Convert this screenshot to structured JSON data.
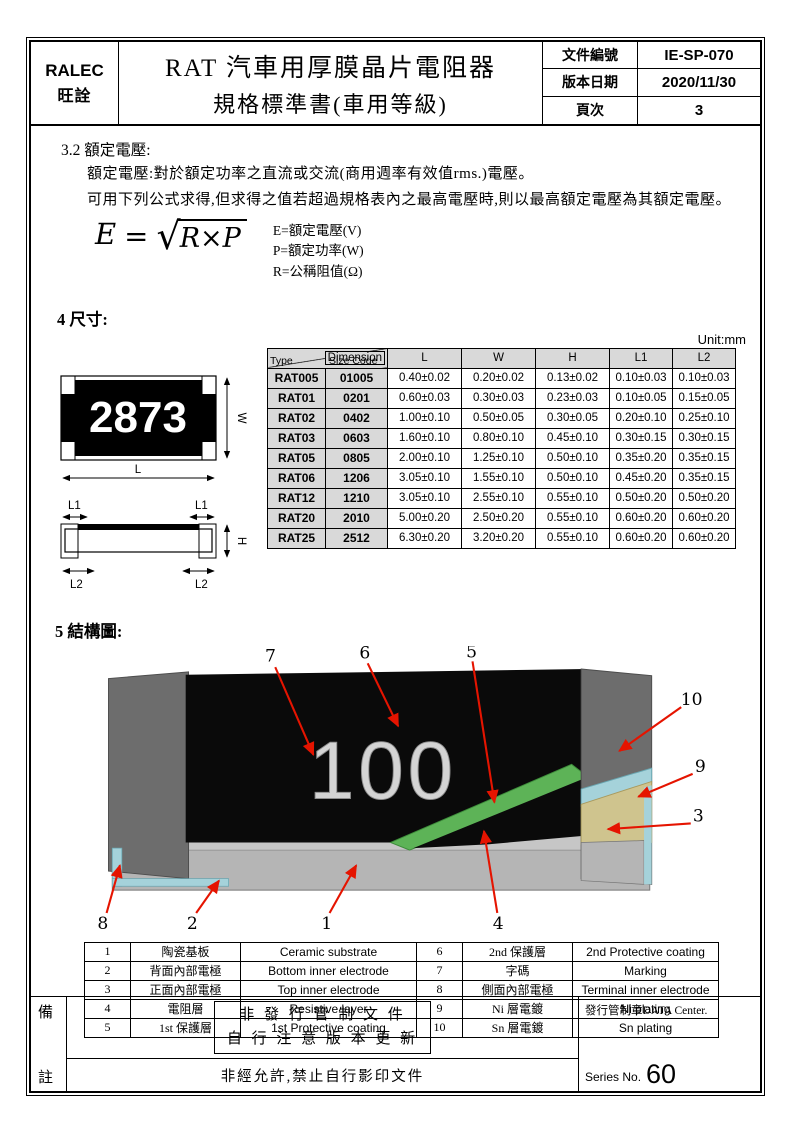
{
  "header": {
    "company_en": "RALEC",
    "company_cn": "旺詮",
    "title_line1": "RAT 汽車用厚膜晶片電阻器",
    "title_line2": "規格標準書(車用等級)",
    "doc_no_label": "文件編號",
    "doc_no": "IE-SP-070",
    "version_date_label": "版本日期",
    "version_date": "2020/11/30",
    "page_label": "頁次",
    "page_no": "3"
  },
  "section_rated_voltage": {
    "number": "3.2",
    "title": "額定電壓:",
    "line1": "額定電壓:對於額定功率之直流或交流(商用週率有效值rms.)電壓。",
    "line2": "可用下列公式求得,但求得之值若超過規格表內之最高電壓時,則以最高額定電壓為其額定電壓。",
    "formula": {
      "lhs": "E",
      "eq": "=",
      "radical": "√",
      "radicand": "R×P"
    },
    "legend": [
      "E=額定電壓(V)",
      "P=額定功率(W)",
      "R=公稱阻值(Ω)"
    ]
  },
  "section_dimensions": {
    "number": "4",
    "title": "尺寸:",
    "unit": "Unit:mm",
    "marking_example": "2873",
    "dim_labels": {
      "L": "L",
      "W": "W",
      "H": "H",
      "L1": "L1",
      "L2": "L2"
    },
    "table": {
      "corner_top": "Dimension",
      "corner_left": "Type",
      "corner_mid": "Size Code",
      "columns": [
        "L",
        "W",
        "H",
        "L1",
        "L2"
      ],
      "rows": [
        {
          "type": "RAT005",
          "size_code": "01005",
          "values": [
            "0.40±0.02",
            "0.20±0.02",
            "0.13±0.02",
            "0.10±0.03",
            "0.10±0.03"
          ]
        },
        {
          "type": "RAT01",
          "size_code": "0201",
          "values": [
            "0.60±0.03",
            "0.30±0.03",
            "0.23±0.03",
            "0.10±0.05",
            "0.15±0.05"
          ]
        },
        {
          "type": "RAT02",
          "size_code": "0402",
          "values": [
            "1.00±0.10",
            "0.50±0.05",
            "0.30±0.05",
            "0.20±0.10",
            "0.25±0.10"
          ]
        },
        {
          "type": "RAT03",
          "size_code": "0603",
          "values": [
            "1.60±0.10",
            "0.80±0.10",
            "0.45±0.10",
            "0.30±0.15",
            "0.30±0.15"
          ]
        },
        {
          "type": "RAT05",
          "size_code": "0805",
          "values": [
            "2.00±0.10",
            "1.25±0.10",
            "0.50±0.10",
            "0.35±0.20",
            "0.35±0.15"
          ]
        },
        {
          "type": "RAT06",
          "size_code": "1206",
          "values": [
            "3.05±0.10",
            "1.55±0.10",
            "0.50±0.10",
            "0.45±0.20",
            "0.35±0.15"
          ]
        },
        {
          "type": "RAT12",
          "size_code": "1210",
          "values": [
            "3.05±0.10",
            "2.55±0.10",
            "0.55±0.10",
            "0.50±0.20",
            "0.50±0.20"
          ]
        },
        {
          "type": "RAT20",
          "size_code": "2010",
          "values": [
            "5.00±0.20",
            "2.50±0.20",
            "0.55±0.10",
            "0.60±0.20",
            "0.60±0.20"
          ]
        },
        {
          "type": "RAT25",
          "size_code": "2512",
          "values": [
            "6.30±0.20",
            "3.20±0.20",
            "0.55±0.10",
            "0.60±0.20",
            "0.60±0.20"
          ]
        }
      ]
    }
  },
  "section_structure": {
    "number": "5",
    "title": "結構圖:",
    "marking": "100",
    "callouts": [
      "1",
      "2",
      "3",
      "4",
      "5",
      "6",
      "7",
      "8",
      "9",
      "10"
    ],
    "parts": [
      {
        "no": "1",
        "cn": "陶瓷基板",
        "en": "Ceramic substrate"
      },
      {
        "no": "2",
        "cn": "背面內部電極",
        "en": "Bottom inner electrode"
      },
      {
        "no": "3",
        "cn": "正面內部電極",
        "en": "Top inner electrode"
      },
      {
        "no": "4",
        "cn": "電阻層",
        "en": "Resistive layer"
      },
      {
        "no": "5",
        "cn": "1st 保護層",
        "en": "1st Protective coating"
      },
      {
        "no": "6",
        "cn": "2nd 保護層",
        "en": "2nd Protective coating"
      },
      {
        "no": "7",
        "cn": "字碼",
        "en": "Marking"
      },
      {
        "no": "8",
        "cn": "側面內部電極",
        "en": "Terminal inner electrode"
      },
      {
        "no": "9",
        "cn": "Ni 層電鍍",
        "en": "Ni plating"
      },
      {
        "no": "10",
        "cn": "Sn 層電鍍",
        "en": "Sn plating"
      }
    ]
  },
  "footer": {
    "left_top": "備",
    "left_bottom": "註",
    "stamp_line1": "非 發 行 管 制 文 件",
    "stamp_line2": "自 行 注 意 版 本 更 新",
    "copy_notice": "非經允許,禁止自行影印文件",
    "control_stamp": "發行管制章DATA Center.",
    "series_label": "Series No.",
    "series_no": "60"
  },
  "colors": {
    "arrow_red": "#e51400",
    "coating_black": "#0a0a0a",
    "protective_green": "#5db357",
    "plating_cyan": "#a5d2da",
    "electrode_tan": "#cfc48e",
    "substrate_gray": "#b5b5b5",
    "terminal_gray": "#6d6d6d"
  }
}
